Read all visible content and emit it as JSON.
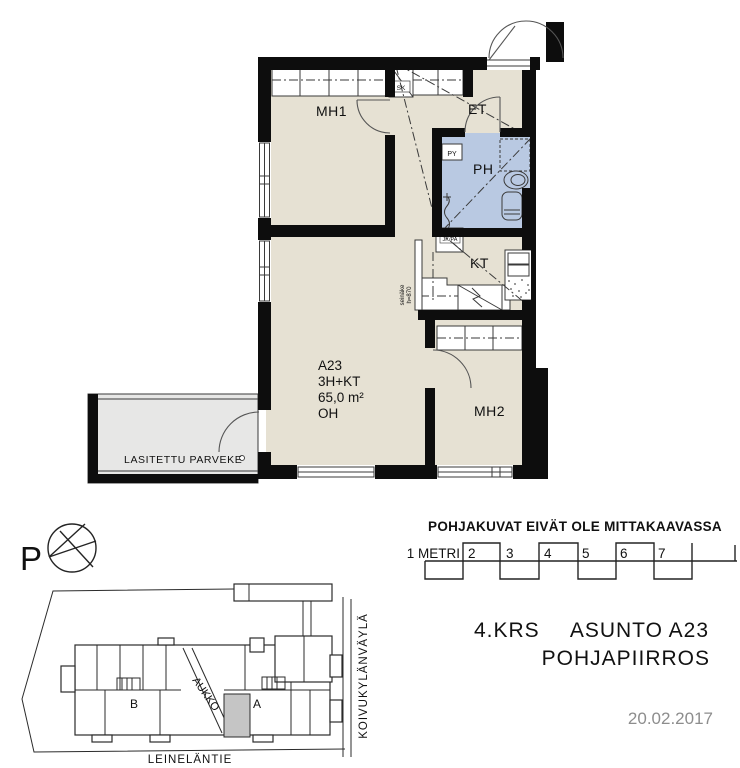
{
  "floor_plan": {
    "rooms": {
      "mh1": "MH1",
      "et": "ET",
      "ph": "PH",
      "kt": "KT",
      "mh2": "MH2"
    },
    "fixtures": {
      "py": "PY",
      "sk": "SK",
      "jk_pa": "JK/PA",
      "seinake_line1": "seinäke",
      "seinake_line2": "h=870"
    },
    "apartment": {
      "id": "A23",
      "type": "3H+KT",
      "area": "65,0 m²",
      "living_room": "OH"
    },
    "balcony": "LASITETTU PARVEKE",
    "colors": {
      "floor": "#e6e1d3",
      "bathroom": "#b9c9e2",
      "balcony": "#e7e7e6",
      "wall": "#0d0d0d"
    }
  },
  "compass": {
    "north_label": "P"
  },
  "scale_bar": {
    "disclaimer": "POHJAKUVAT EIVÄT OLE MITTAKAAVASSA",
    "unit_label": "1 METRI",
    "ticks": [
      "2",
      "3",
      "4",
      "5",
      "6",
      "7"
    ]
  },
  "site_plan": {
    "building_a": "A",
    "building_b": "B",
    "opening": "AUKKO",
    "street_south": "LEINELÄNTIE",
    "street_east": "KOIVUKYLÄNVÄYLÄ",
    "unit_fill": "#c5c5c5"
  },
  "title_block": {
    "floor": "4.KRS",
    "apartment": "ASUNTO A23",
    "drawing": "POHJAPIIRROS",
    "date": "20.02.2017"
  }
}
